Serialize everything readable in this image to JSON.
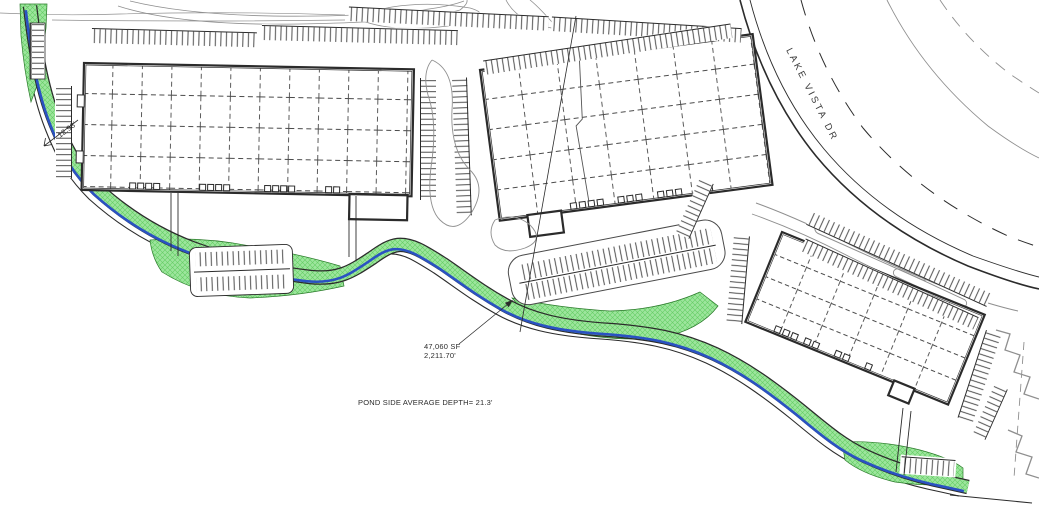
{
  "drawing": {
    "road": {
      "name": "LAKE VISTA DR"
    },
    "labels": {
      "offset_dimension": "12.98'",
      "buffer_area": "47,060 SF",
      "buffer_length": "2,211.70'",
      "pond_note": "POND SIDE AVERAGE DEPTH= 21.3'"
    },
    "colors": {
      "background": "#ffffff",
      "buffer_green": "#9de59d",
      "buffer_hatch": "#55c855",
      "waterline_blue": "#2a52c2",
      "linework": "#2b2b2b",
      "light_line": "#8f8f8f"
    }
  }
}
